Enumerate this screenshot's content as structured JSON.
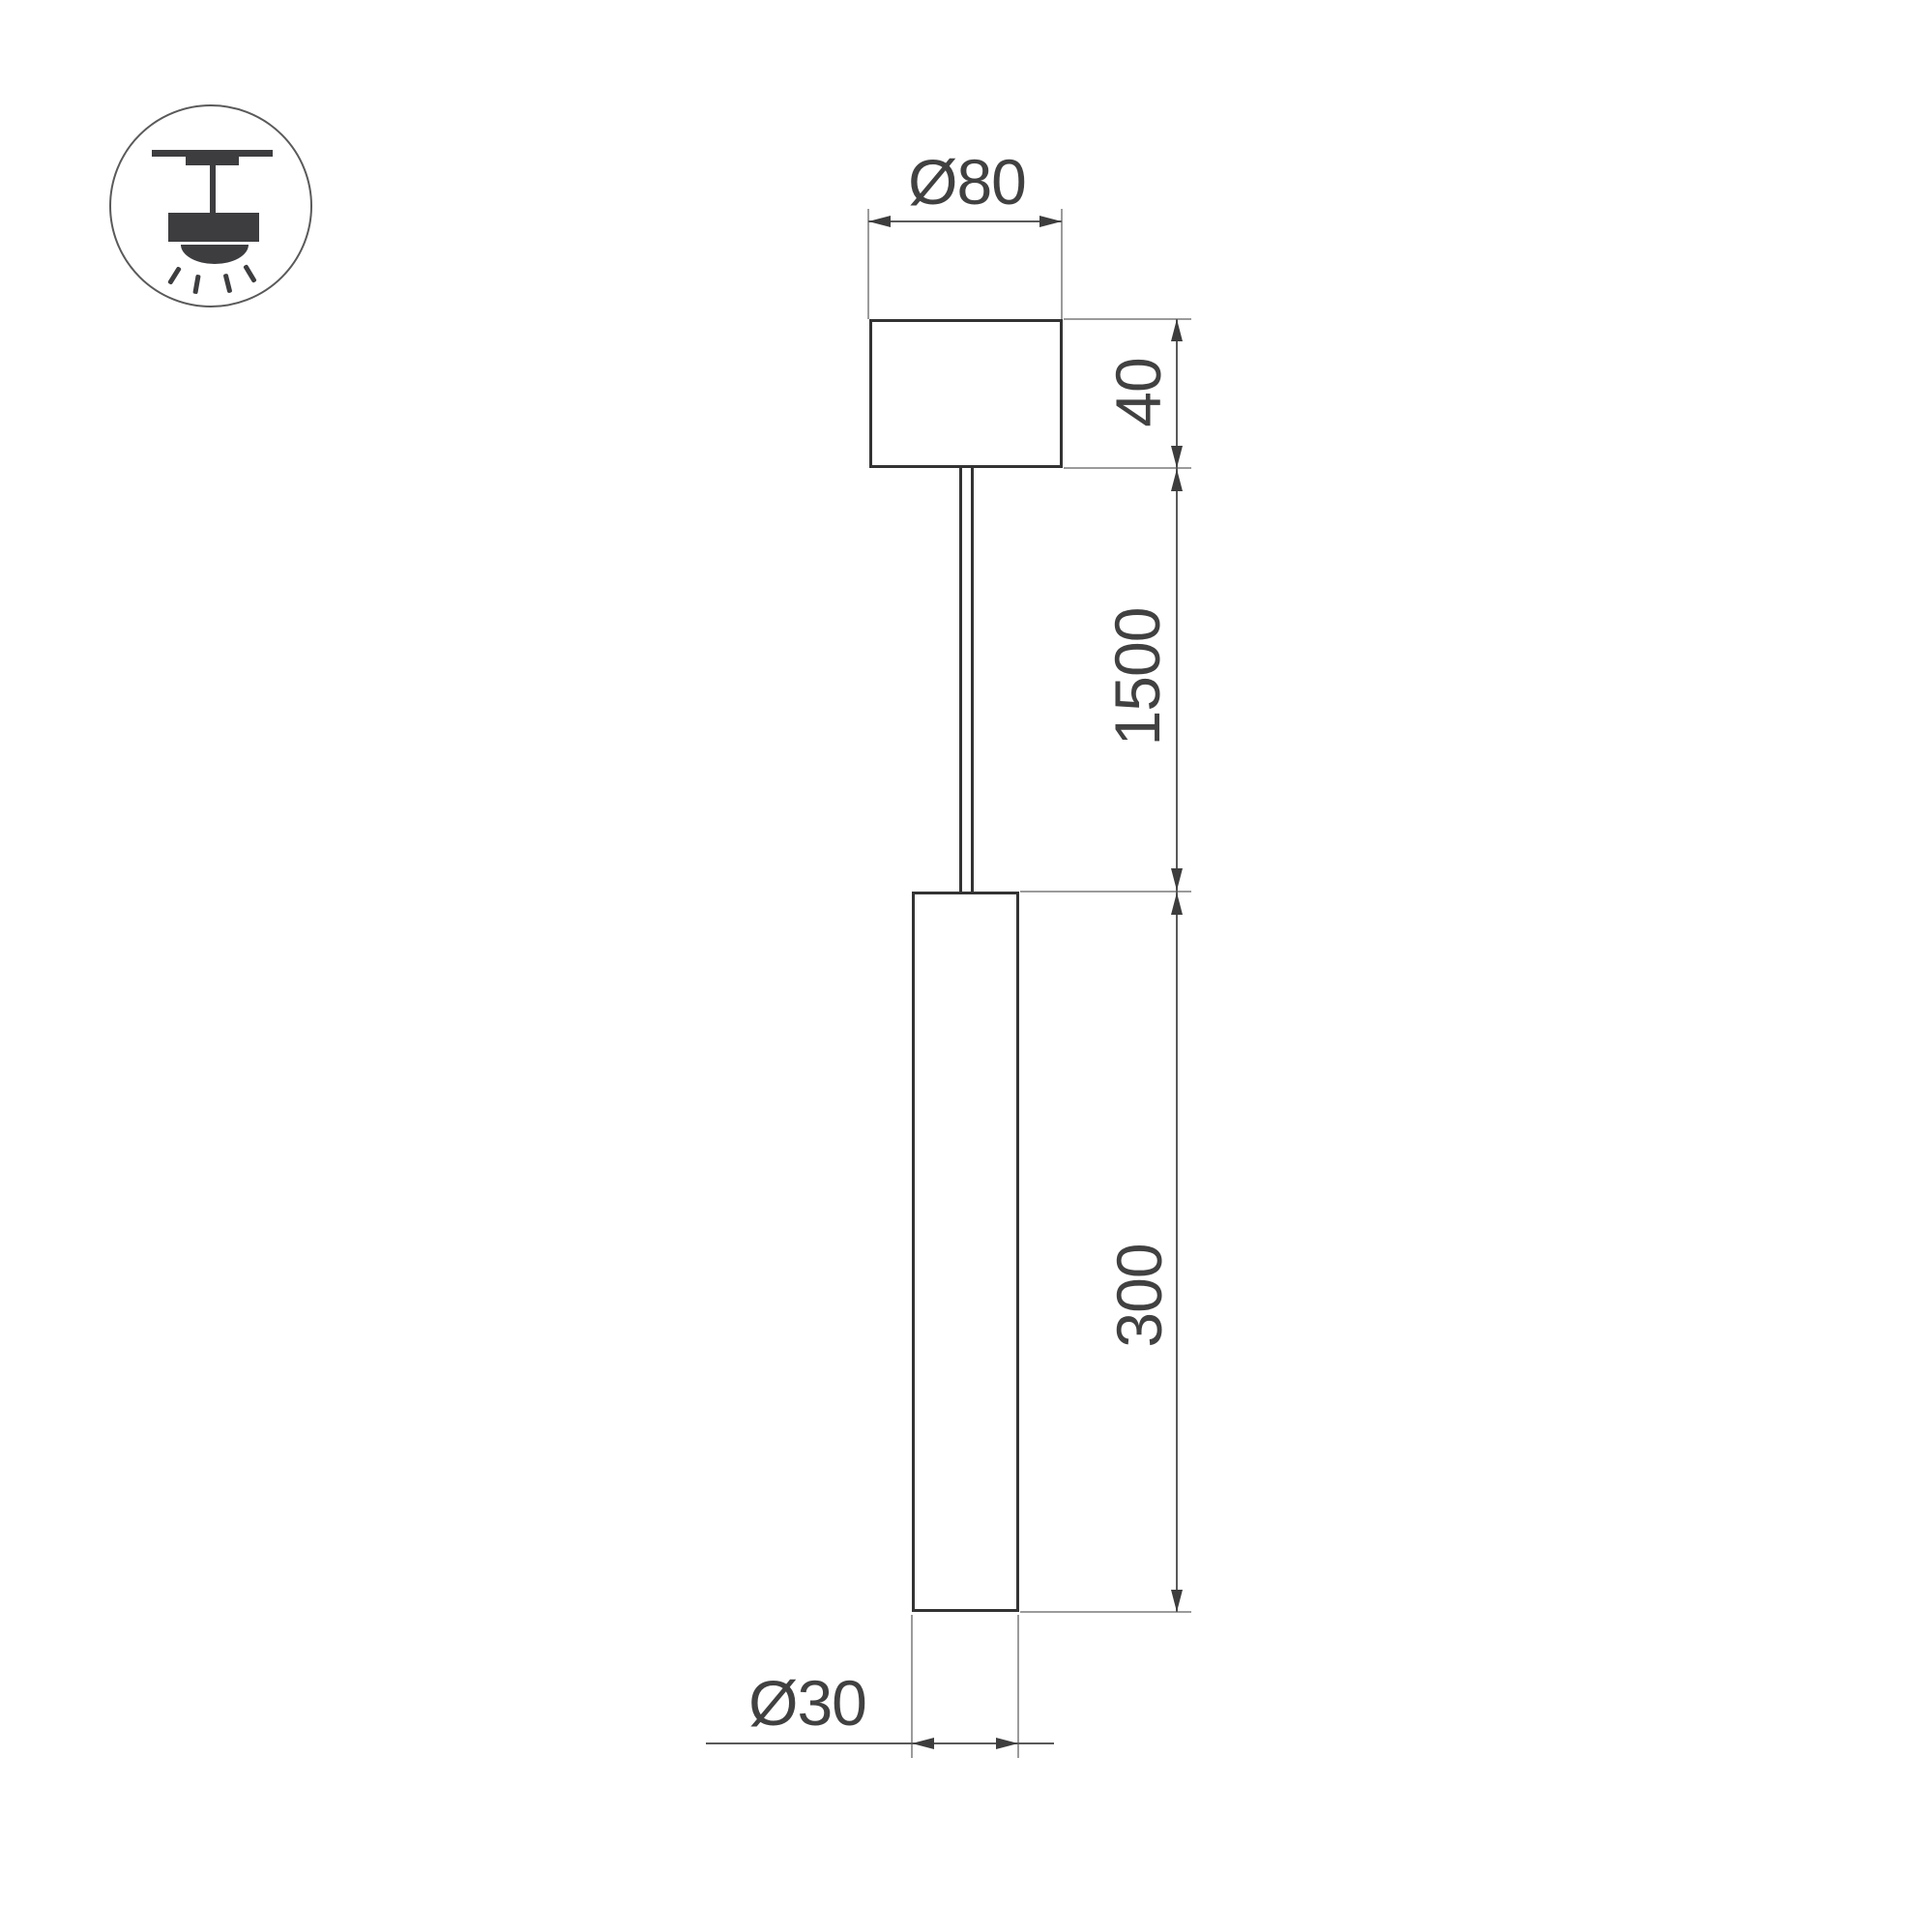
{
  "drawing": {
    "kind": "pendant-lamp-dimension-drawing",
    "icon": "ceiling-pendant-mount-icon",
    "labels": {
      "canopy_diameter": "Ø80",
      "canopy_height": "40",
      "suspension_length": "1500",
      "lamp_length": "300",
      "lamp_diameter": "Ø30"
    }
  },
  "colors": {
    "bg": "#ffffff",
    "outline": "#333333",
    "ext": "#9b9b9b",
    "dim": "#5a5a5a",
    "arrow": "#3d3d3d",
    "text": "#414141",
    "icon": "#3d3d40",
    "icon-ring": "#5a5a5a"
  }
}
